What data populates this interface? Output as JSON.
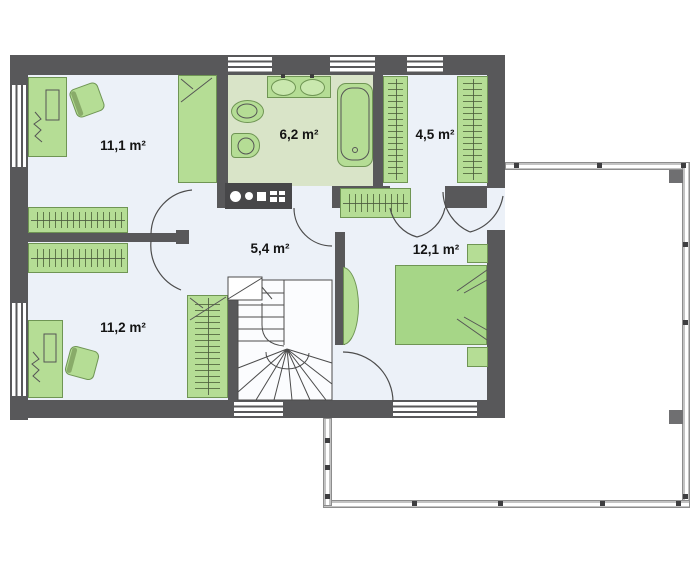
{
  "plan": {
    "type": "floor-plan",
    "rooms": [
      {
        "id": "room-upper-left",
        "area_label": "11,1 m²"
      },
      {
        "id": "bathroom",
        "area_label": "6,2 m²"
      },
      {
        "id": "wardrobe-closet",
        "area_label": "4,5 m²"
      },
      {
        "id": "hallway",
        "area_label": "5,4 m²"
      },
      {
        "id": "bedroom-right",
        "area_label": "12,1 m²"
      },
      {
        "id": "room-lower-left",
        "area_label": "11,2 m²"
      }
    ]
  },
  "colors": {
    "wall": "#58585a",
    "floor": "#ecf1f8",
    "bath_floor": "#d9e4c8",
    "furniture": "#b5dd95",
    "furniture_border": "#6f9554",
    "bed": "#a6d687",
    "sketch": "#4c4c4c",
    "label": "#141414",
    "rail_fill": "#c3c3c3",
    "rail_border": "#8d8d8d",
    "post": "#3e3e40",
    "appliance": "#474749"
  }
}
